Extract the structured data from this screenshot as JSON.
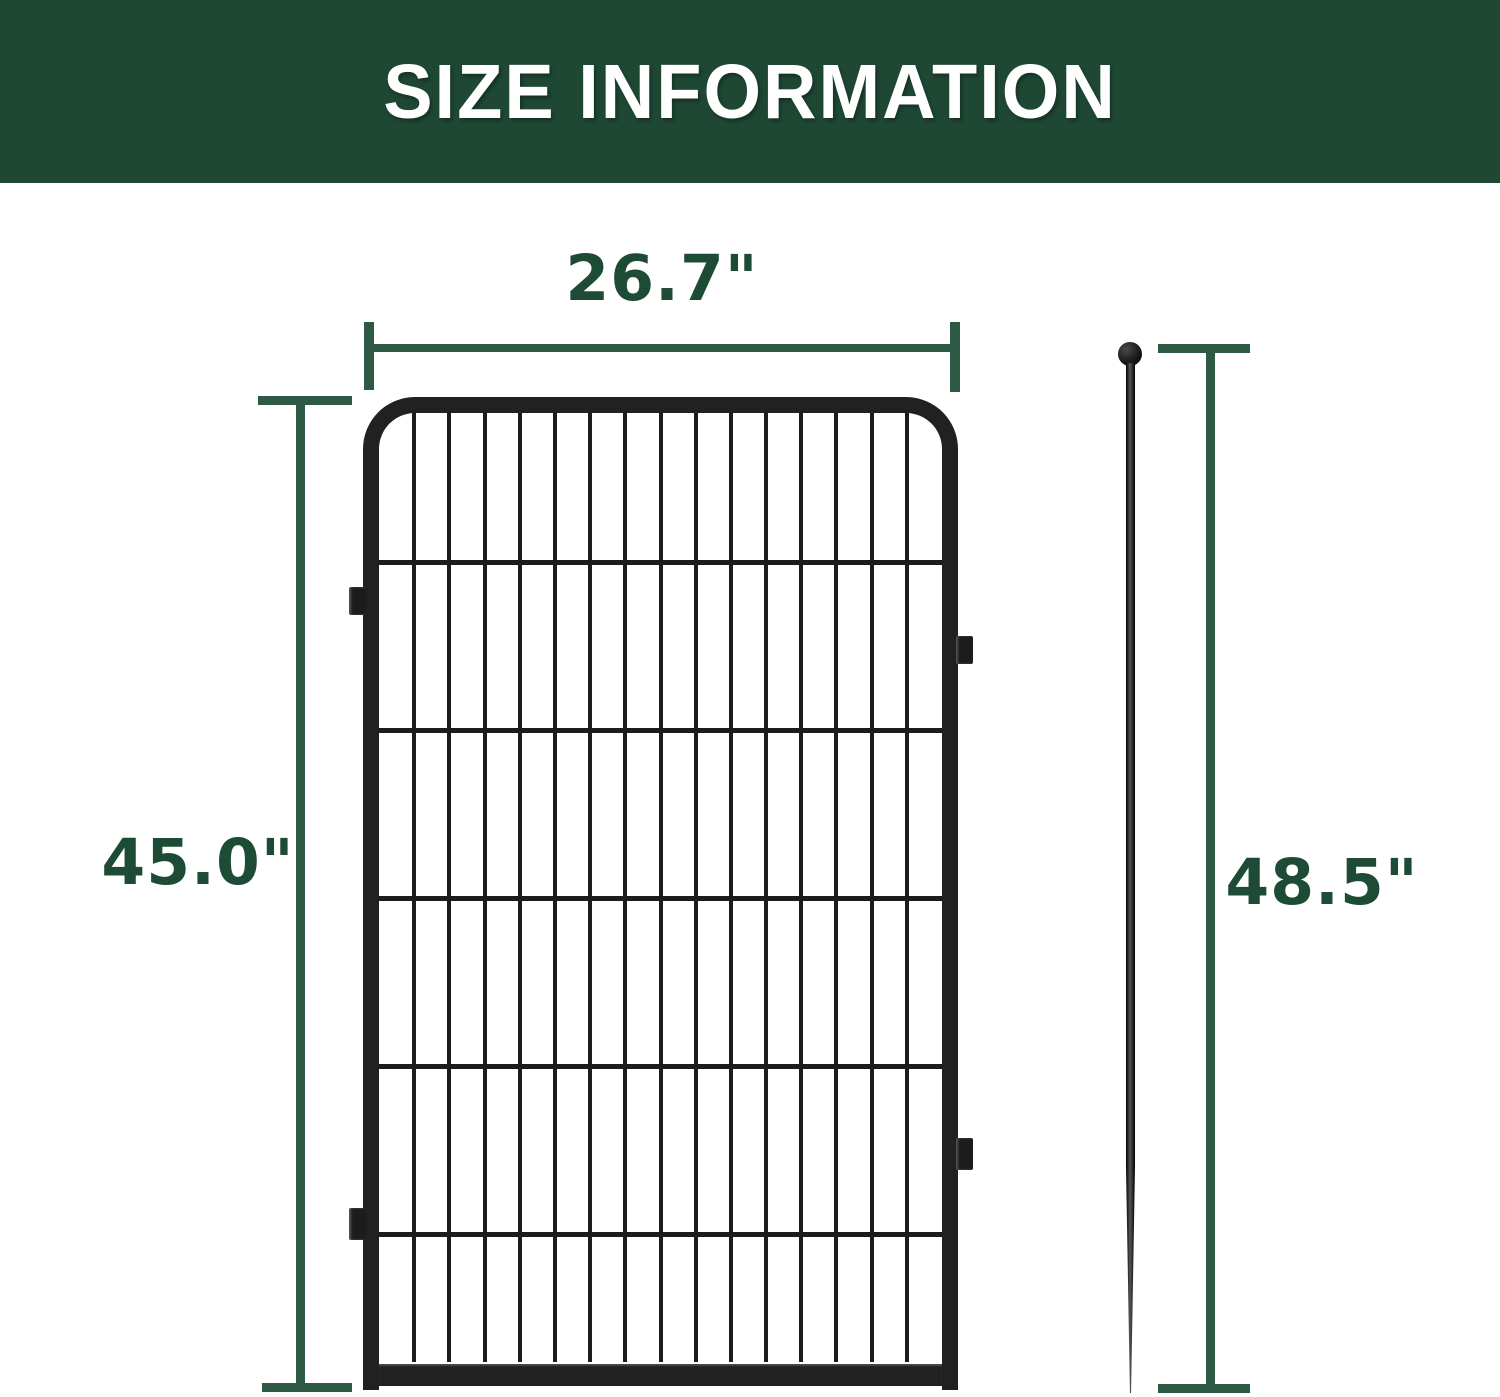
{
  "header": {
    "title": "SIZE INFORMATION"
  },
  "dimensions": {
    "panel_width": {
      "label": "26.7\""
    },
    "panel_height": {
      "label": "45.0\""
    },
    "stake_height": {
      "label": "48.5\""
    }
  },
  "panel": {
    "columns": 16,
    "h_wire_offsets_px": [
      147,
      315,
      483,
      651,
      819
    ]
  },
  "colors": {
    "header_bg": "#1E4734",
    "header_text": "#FFFFFF",
    "dimension_line": "#2D5945",
    "dimension_text": "#1D4B35",
    "metal": "#212121",
    "wire": "#1C1C1C",
    "background": "#FFFFFF"
  }
}
